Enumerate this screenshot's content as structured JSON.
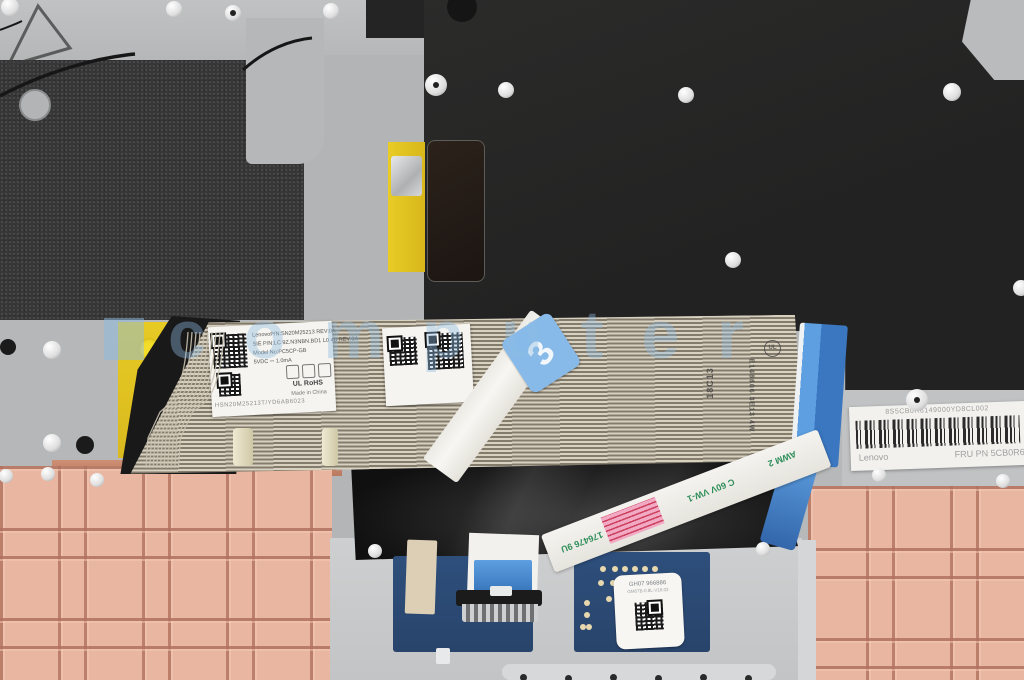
{
  "photo": {
    "watermark_text": "computer",
    "keyboard_label": {
      "line1": "LenovoP/N:SN20M25213        REV:0A",
      "line2": "SIE P/N:LC 9Z.N3NBN.BD1 L0 4B REV:0A",
      "line3": "Model No:PC5CP-GB",
      "line4": "5VDC ⎓ 1.0mA",
      "serial": "HSN20M25213T/YD6AB6023",
      "rohs": "UL RoHS",
      "origin": "Made in China"
    },
    "cable_marks": {
      "mark1": "18C13",
      "mark2": "E148606 3E13 4W",
      "ul": "UL",
      "sticker": "3"
    },
    "touchpad_cable": {
      "text1": "176476 9U",
      "text2": "C 60V VW-1",
      "text3": "AWM 2"
    },
    "touchpad_label": {
      "line1": "GH07 966886",
      "line2": "GM07B-0.8L-V16.02"
    },
    "fru_label": {
      "top_code": "8S5CB0R6149000YD8CL002",
      "brand": "Lenovo",
      "fru": "FRU PN 5CB0R6"
    }
  }
}
